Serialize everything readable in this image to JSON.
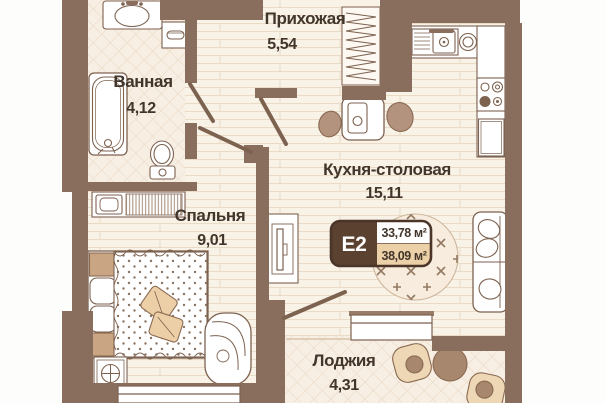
{
  "unit": {
    "code": "E2",
    "area_living": "33,78 м²",
    "area_total": "38,09 м²"
  },
  "rooms": {
    "bathroom": {
      "name": "Ванная",
      "area": "4,12"
    },
    "hallway": {
      "name": "Прихожая",
      "area": "5,54"
    },
    "kitchen": {
      "name": "Кухня-столовая",
      "area": "15,11"
    },
    "bedroom": {
      "name": "Спальня",
      "area": "9,01"
    },
    "loggia": {
      "name": "Лоджия",
      "area": "4,31"
    }
  },
  "colors": {
    "wall": "#8a6e5d",
    "floor_plank": "#f9f2e7",
    "floor_tile": "#f8efe4",
    "badge_dark": "#5a4130",
    "badge_tan": "#ecd0a8",
    "furniture_line": "#7d6250",
    "accent_tan": "#eccfa6",
    "text": "#42352a"
  }
}
